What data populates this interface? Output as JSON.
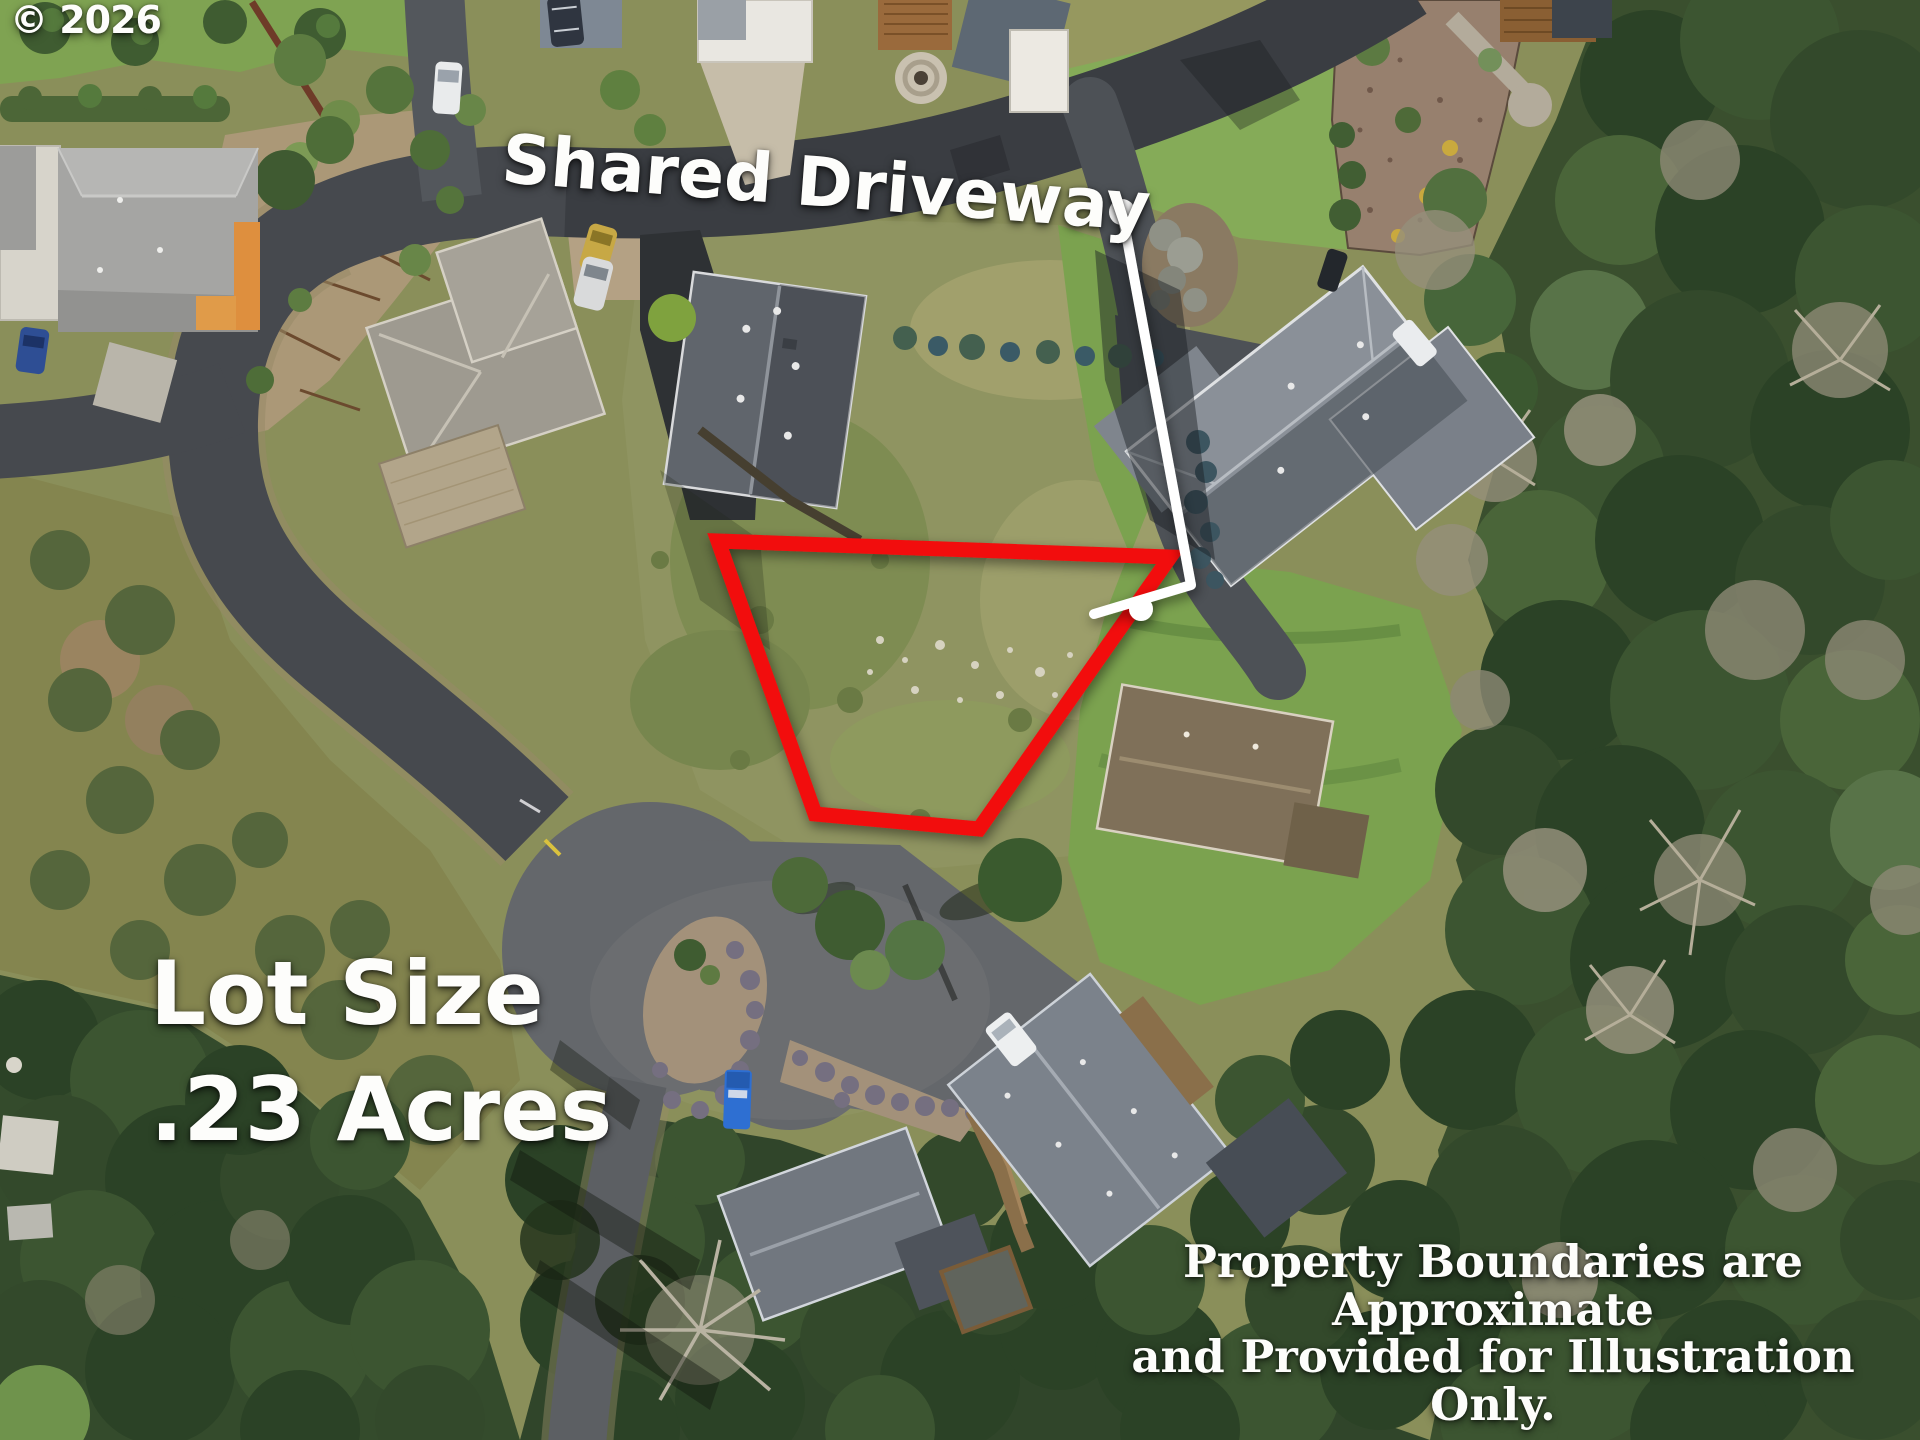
{
  "watermark": {
    "text": "© 2026"
  },
  "labels": {
    "street": "Shared Driveway",
    "lot_size_line1": "Lot Size",
    "lot_size_line2": ".23 Acres",
    "disclaimer_line1": "Property Boundaries are Approximate",
    "disclaimer_line2": "and Provided for Illustration Only."
  },
  "annotations": {
    "boundary_color": "#f20d0d",
    "boundary_points": "718,541 1170,557 979,829 815,814",
    "callout_color": "#ffffff",
    "callout_line_points": "1122,212 1191,585 1094,614",
    "callout_dot_start": {
      "cx": "1122",
      "cy": "212",
      "r": "13"
    },
    "callout_dot_end": {
      "cx": "1141",
      "cy": "609",
      "r": "12"
    }
  },
  "scene": {
    "type": "aerial-drone-photo",
    "description": "Aerial drone view of a residential cul-de-sac neighborhood: a vacant .23 acre grassy lot outlined in red, reached by a shared driveway traced with a white line; gray-roofed houses, lawns, dirt garden beds and dense evergreen forest surround the street loop.",
    "palette": {
      "asphalt": "#46494e",
      "asphalt_light": "#64676b",
      "field_grass": "#8f9461",
      "lawn": "#7ba24f",
      "forest": "#3a4f2e",
      "dirt": "#ab9877",
      "roof_light_gray": "#a5a5a3",
      "roof_slate": "#60656c",
      "roof_brown": "#7f7059"
    }
  }
}
